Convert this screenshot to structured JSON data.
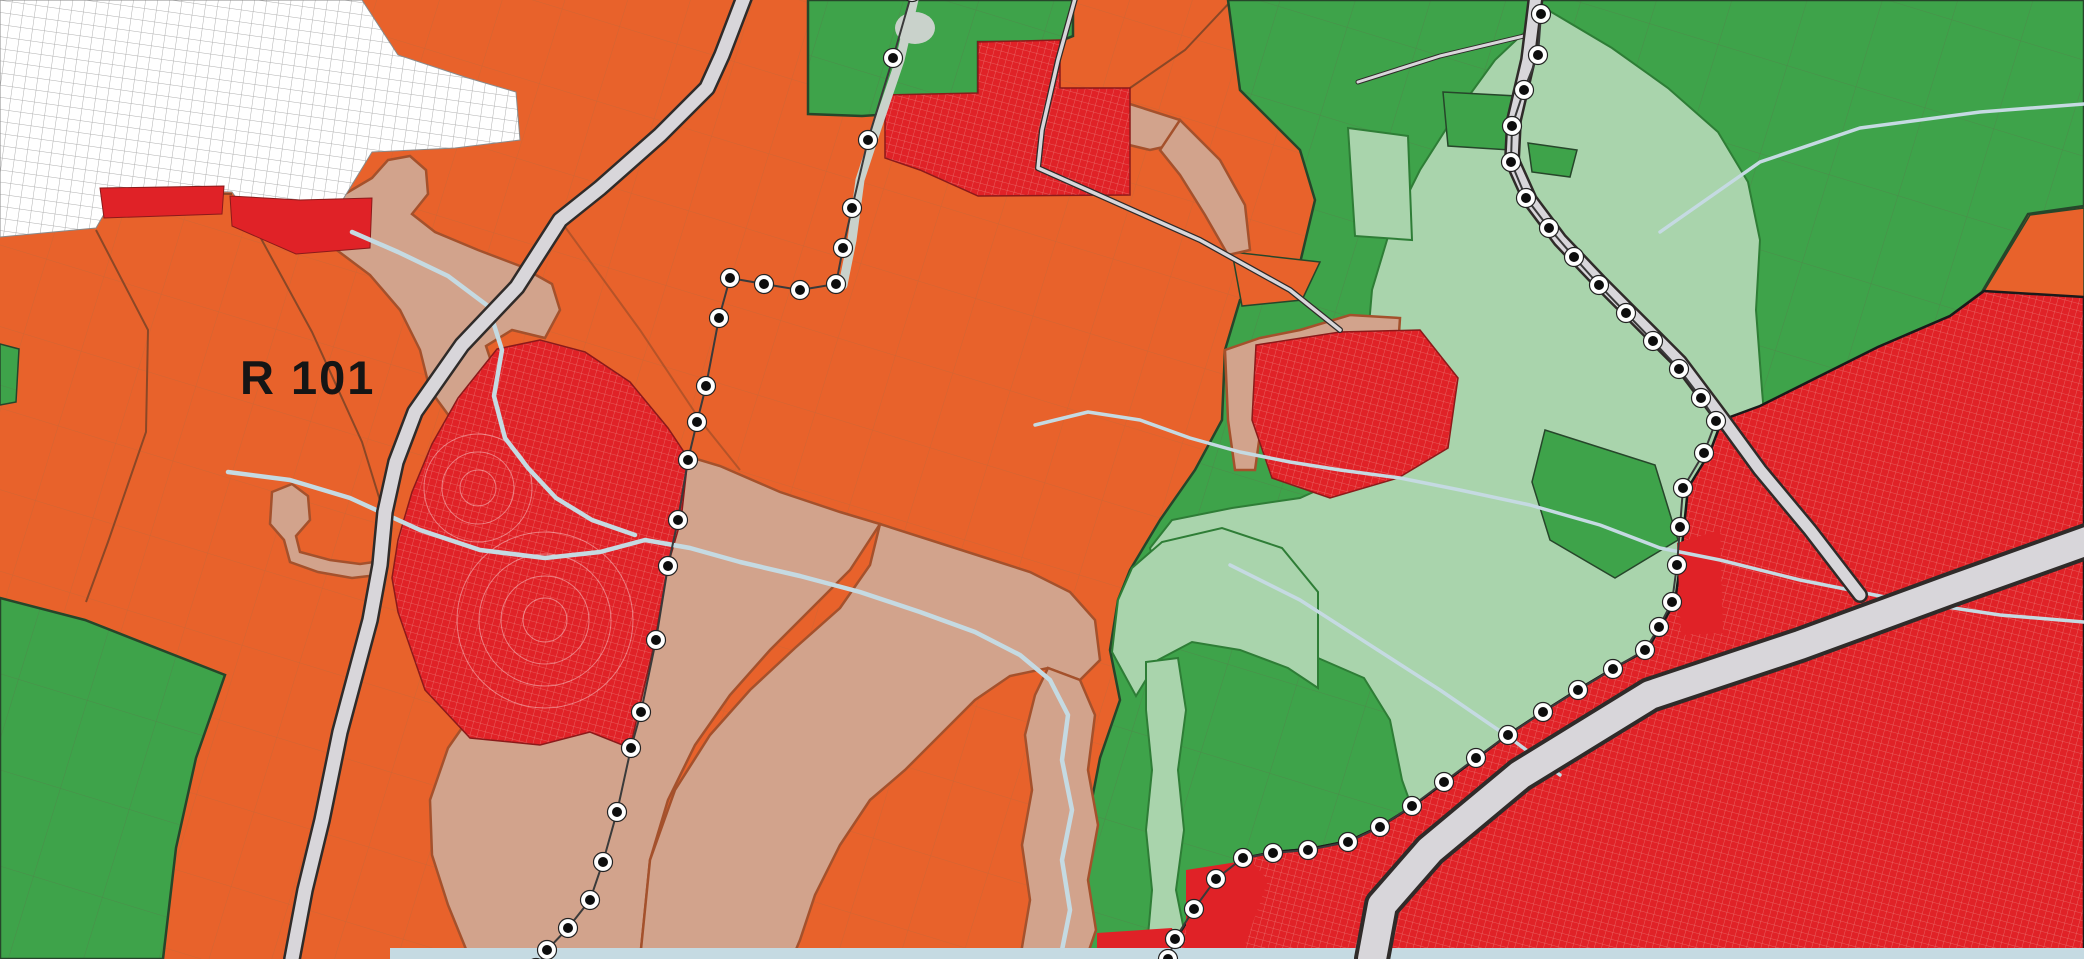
{
  "label": {
    "text": "R 101"
  },
  "colors": {
    "orange": "#E8622B",
    "parcel_line": "#b06a3f",
    "field_line": "#7a4326",
    "green": "#3EA34A",
    "green_border": "#26462a",
    "pale_green": "#A9D4AC",
    "pale_green_border": "#2E7D36",
    "tan": "#D2A38C",
    "tan_border": "#A4512C",
    "red": "#E02227",
    "red_border": "#8B1A1A",
    "red_grid_line": "#f3b9b2",
    "white_area": "#FFFFFF",
    "white_area_line": "#9c9c9c",
    "road_fill": "#D8D6DA",
    "road_casing": "#2F2B29",
    "water": "#C5DAE2",
    "water_corridor": "#C9D2CB",
    "dot_fill": "#0D0D0D",
    "dot_ring": "#FFFFFF",
    "label_color": "#151515"
  },
  "boundaries": {
    "dot_inner_radius": 5,
    "dot_ring_radius": 9.5,
    "lines": [
      {
        "name": "west-plan-boundary",
        "points": [
          [
            912,
            -8
          ],
          [
            893,
            58
          ],
          [
            868,
            140
          ],
          [
            852,
            208
          ],
          [
            843,
            248
          ],
          [
            836,
            284
          ],
          [
            800,
            290
          ],
          [
            764,
            284
          ],
          [
            730,
            278
          ],
          [
            719,
            318
          ],
          [
            706,
            386
          ],
          [
            697,
            422
          ],
          [
            688,
            460
          ],
          [
            678,
            520
          ],
          [
            668,
            566
          ],
          [
            656,
            640
          ],
          [
            641,
            712
          ],
          [
            631,
            748
          ],
          [
            617,
            812
          ],
          [
            603,
            862
          ],
          [
            590,
            900
          ],
          [
            568,
            928
          ],
          [
            547,
            950
          ],
          [
            536,
            968
          ]
        ]
      },
      {
        "name": "east-plan-boundary",
        "points": [
          [
            1541,
            14
          ],
          [
            1538,
            55
          ],
          [
            1524,
            90
          ],
          [
            1512,
            126
          ],
          [
            1511,
            162
          ],
          [
            1526,
            198
          ],
          [
            1549,
            228
          ],
          [
            1574,
            257
          ],
          [
            1599,
            285
          ],
          [
            1626,
            313
          ],
          [
            1653,
            341
          ],
          [
            1679,
            369
          ],
          [
            1701,
            398
          ],
          [
            1716,
            421
          ],
          [
            1704,
            453
          ],
          [
            1683,
            488
          ],
          [
            1680,
            527
          ],
          [
            1677,
            565
          ],
          [
            1672,
            602
          ],
          [
            1659,
            627
          ],
          [
            1645,
            650
          ],
          [
            1613,
            669
          ],
          [
            1578,
            690
          ],
          [
            1543,
            712
          ],
          [
            1508,
            735
          ],
          [
            1476,
            758
          ],
          [
            1444,
            782
          ],
          [
            1412,
            806
          ],
          [
            1380,
            827
          ],
          [
            1348,
            842
          ],
          [
            1308,
            850
          ],
          [
            1273,
            853
          ],
          [
            1243,
            858
          ],
          [
            1216,
            879
          ],
          [
            1194,
            909
          ],
          [
            1175,
            939
          ],
          [
            1168,
            959
          ]
        ]
      }
    ]
  }
}
